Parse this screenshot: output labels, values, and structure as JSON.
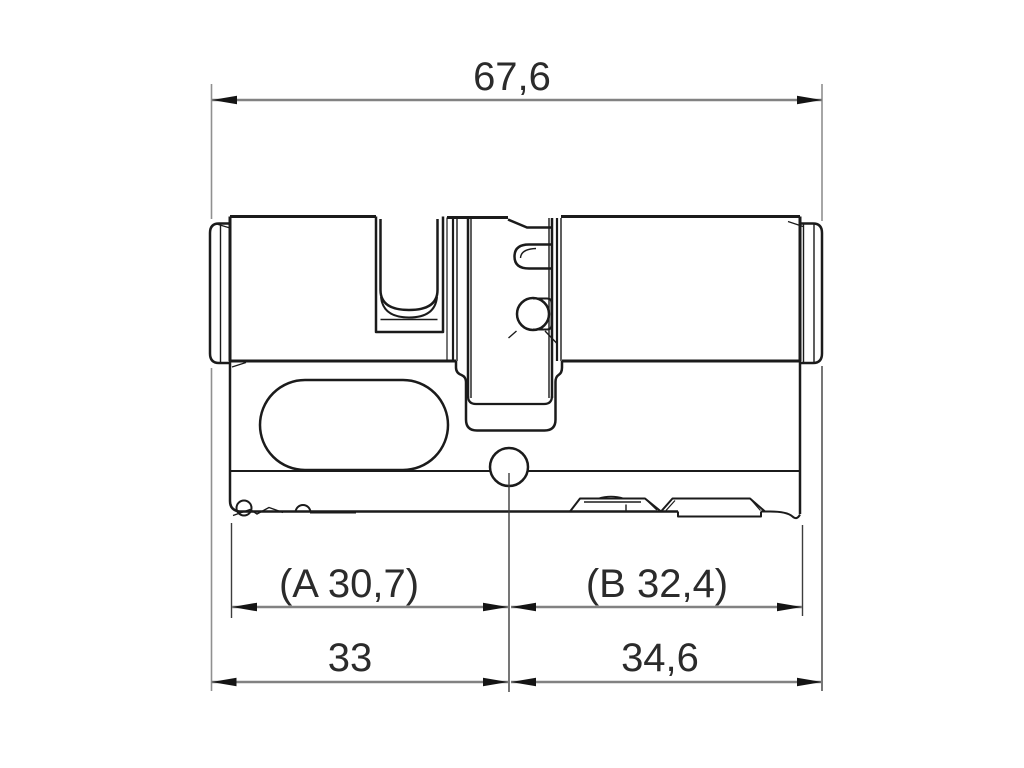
{
  "drawing": {
    "dimensions": {
      "total_length": {
        "label": "67,6",
        "value": 67.6
      },
      "a_measure": {
        "label": "(A 30,7)",
        "value": 30.7
      },
      "b_measure": {
        "label": "(B 32,4)",
        "value": 32.4
      },
      "left_half": {
        "label": "33",
        "value": 33
      },
      "right_half": {
        "label": "34,6",
        "value": 34.6
      }
    },
    "colors": {
      "background": "#ffffff",
      "outline": "#1b1b1b",
      "dimension_line": "#828282",
      "extension_line": "#909090",
      "arrowhead": "#141414",
      "text": "#2b2b2b"
    }
  }
}
